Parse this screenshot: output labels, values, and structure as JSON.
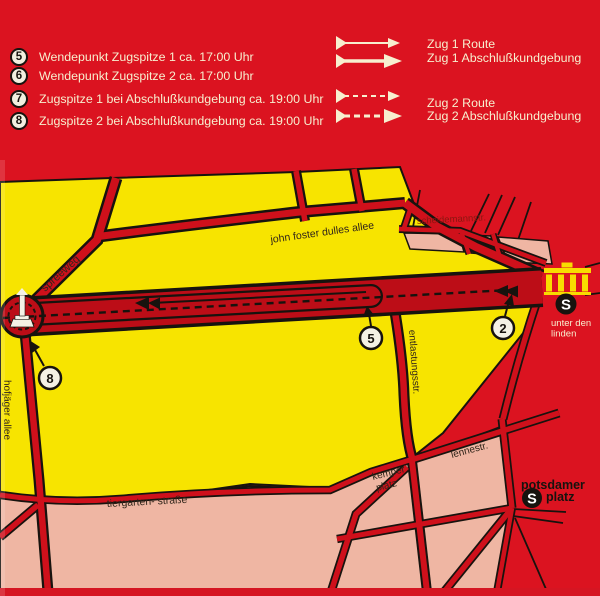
{
  "colors": {
    "background_red": "#db1320",
    "map_yellow": "#f7e400",
    "block_pink": "#efb6a3",
    "road_red": "#cf101b",
    "ink_black": "#17130e",
    "cream_text": "#f7efcf"
  },
  "legend": {
    "items": [
      {
        "num": "5",
        "text": "Wendepunkt Zugspitze 1 ca. 17:00 Uhr"
      },
      {
        "num": "6",
        "text": "Wendepunkt Zugspitze 2 ca. 17:00 Uhr"
      },
      {
        "num": "7",
        "text": "Zugspitze 1 bei Abschlußkundgebung ca. 19:00 Uhr"
      },
      {
        "num": "8",
        "text": "Zugspitze 2 bei Abschlußkundgebung ca. 19:00 Uhr"
      }
    ],
    "routes": [
      {
        "label": "Zug 1 Route"
      },
      {
        "label": "Zug 1 Abschlußkundgebung"
      },
      {
        "label": "Zug 2 Route"
      },
      {
        "label": "Zug 2 Abschlußkundgebung"
      }
    ]
  },
  "map": {
    "streets": {
      "spreeweg": "spreeweg",
      "john_foster": "john foster dulles allee",
      "scheidemann": "scheidemannstr.",
      "entlastung": "entlastungsstr.",
      "hofjaeger": "hofjäger allee",
      "tiergarten": "tiergarten- straße",
      "lenne": "lennestr."
    },
    "places": {
      "kemper_line1": "kemper",
      "kemper_line2": "platz",
      "potsdamer_line1": "potsdamer",
      "potsdamer_line2": "platz",
      "unter_line1": "unter den",
      "unter_line2": "linden"
    },
    "markers": {
      "m5": "5",
      "m2": "2",
      "m8": "8"
    },
    "sbahn": "S"
  }
}
